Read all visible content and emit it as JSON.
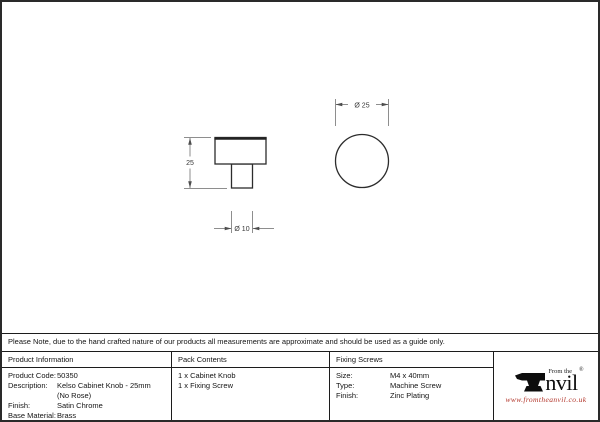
{
  "note": "Please Note, due to the hand crafted nature of our products all measurements are approximate and should be used as a guide only.",
  "drawing": {
    "side_view": {
      "height_label": "25",
      "stem_diameter_label": "Ø 10"
    },
    "top_view": {
      "diameter_label": "Ø 25"
    }
  },
  "table": {
    "product_information": {
      "header": "Product Information",
      "rows": [
        {
          "label": "Product Code:",
          "value": "50350"
        },
        {
          "label": "Description:",
          "value": "Kelso Cabinet Knob - 25mm"
        },
        {
          "label": "",
          "value": "(No Rose)"
        },
        {
          "label": "Finish:",
          "value": "Satin Chrome"
        },
        {
          "label": "Base Material:",
          "value": "Brass"
        }
      ]
    },
    "pack_contents": {
      "header": "Pack Contents",
      "items": [
        "1 x Cabinet Knob",
        "1 x Fixing Screw"
      ]
    },
    "fixing_screws": {
      "header": "Fixing Screws",
      "rows": [
        {
          "label": "Size:",
          "value": "M4 x 40mm"
        },
        {
          "label": "Type:",
          "value": "Machine Screw"
        },
        {
          "label": "Finish:",
          "value": "Zinc Plating"
        }
      ]
    },
    "logo": {
      "tagline": "From the",
      "name_rest": "nvil",
      "registered": "®",
      "url": "www.fromtheanvil.co.uk",
      "url_color": "#b23429"
    }
  }
}
